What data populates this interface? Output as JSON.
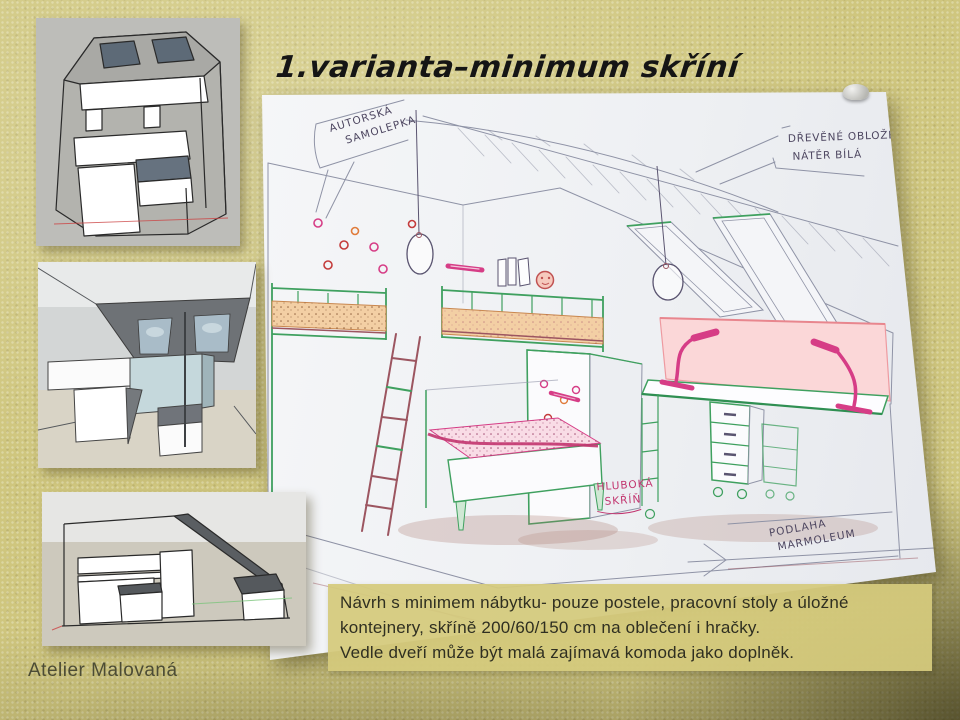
{
  "slide": {
    "title": "1.varianta–minimum skříní",
    "footer": "Atelier Malovaná",
    "caption": {
      "line1": "Návrh s minimem nábytku- pouze postele, pracovní stoly a úložné",
      "line2": "kontejnery, skříně 200/60/150 cm na oblečení i hračky.",
      "line3": "Vedle dveří může být malá zajímavá komoda jako doplněk."
    },
    "annotations": {
      "sticker_line1": "AUTORSKÁ",
      "sticker_line2": "SAMOLEPKA",
      "paneling_line1": "DŘEVĚNÉ OBLOŽENÍ",
      "paneling_line2": "NÁTĚR BÍLÁ",
      "wardrobe_line1": "HLUBOKÁ",
      "wardrobe_line2": "SKŘÍŇ",
      "floor_line1": "PODLAHA",
      "floor_line2": "MARMOLEUM"
    },
    "colors": {
      "background": "#cfc67e",
      "caption_bg": "#d5ca7c",
      "ink_green": "#3fa05f",
      "ink_pink": "#d63d86",
      "ink_pencil": "#8f93a6",
      "mattress_tan": "#f3cfa4"
    }
  }
}
